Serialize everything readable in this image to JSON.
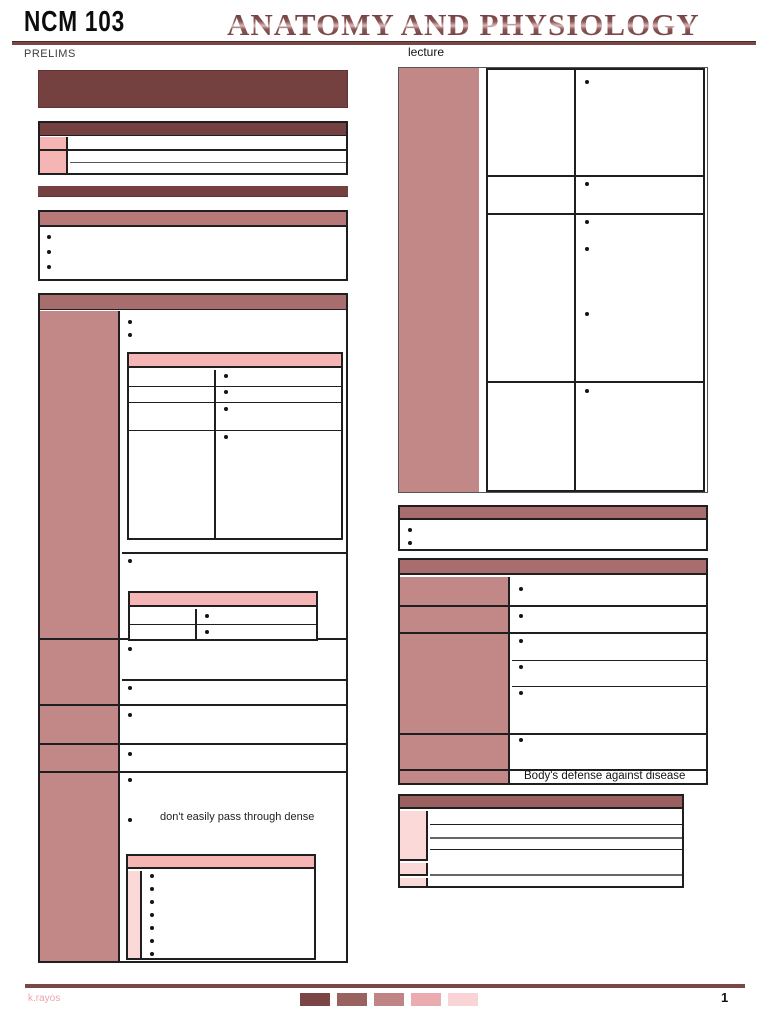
{
  "header": {
    "course_code": "NCM 103",
    "title": "ANATOMY AND PHYSIOLOGY",
    "term": "PRELIMS",
    "section_label": "lecture"
  },
  "content": {
    "left_note": "don't easily pass through dense",
    "right_note": "Body's defense against disease"
  },
  "footer": {
    "author": "k.rayos",
    "page_number": "1",
    "swatches": [
      "#7c4545",
      "#9a6161",
      "#c18484",
      "#eaacaf",
      "#f9d4d6"
    ]
  },
  "colors": {
    "dark_maroon": "#744040",
    "mid_maroon": "#a86e6e",
    "rose": "#b87878",
    "mauve": "#c28888",
    "pink": "#f5b5b5",
    "light_pink": "#fbd9d9",
    "rule": "#7a4747",
    "header_small": "#9a6060",
    "author_pink": "#eba6ad"
  }
}
